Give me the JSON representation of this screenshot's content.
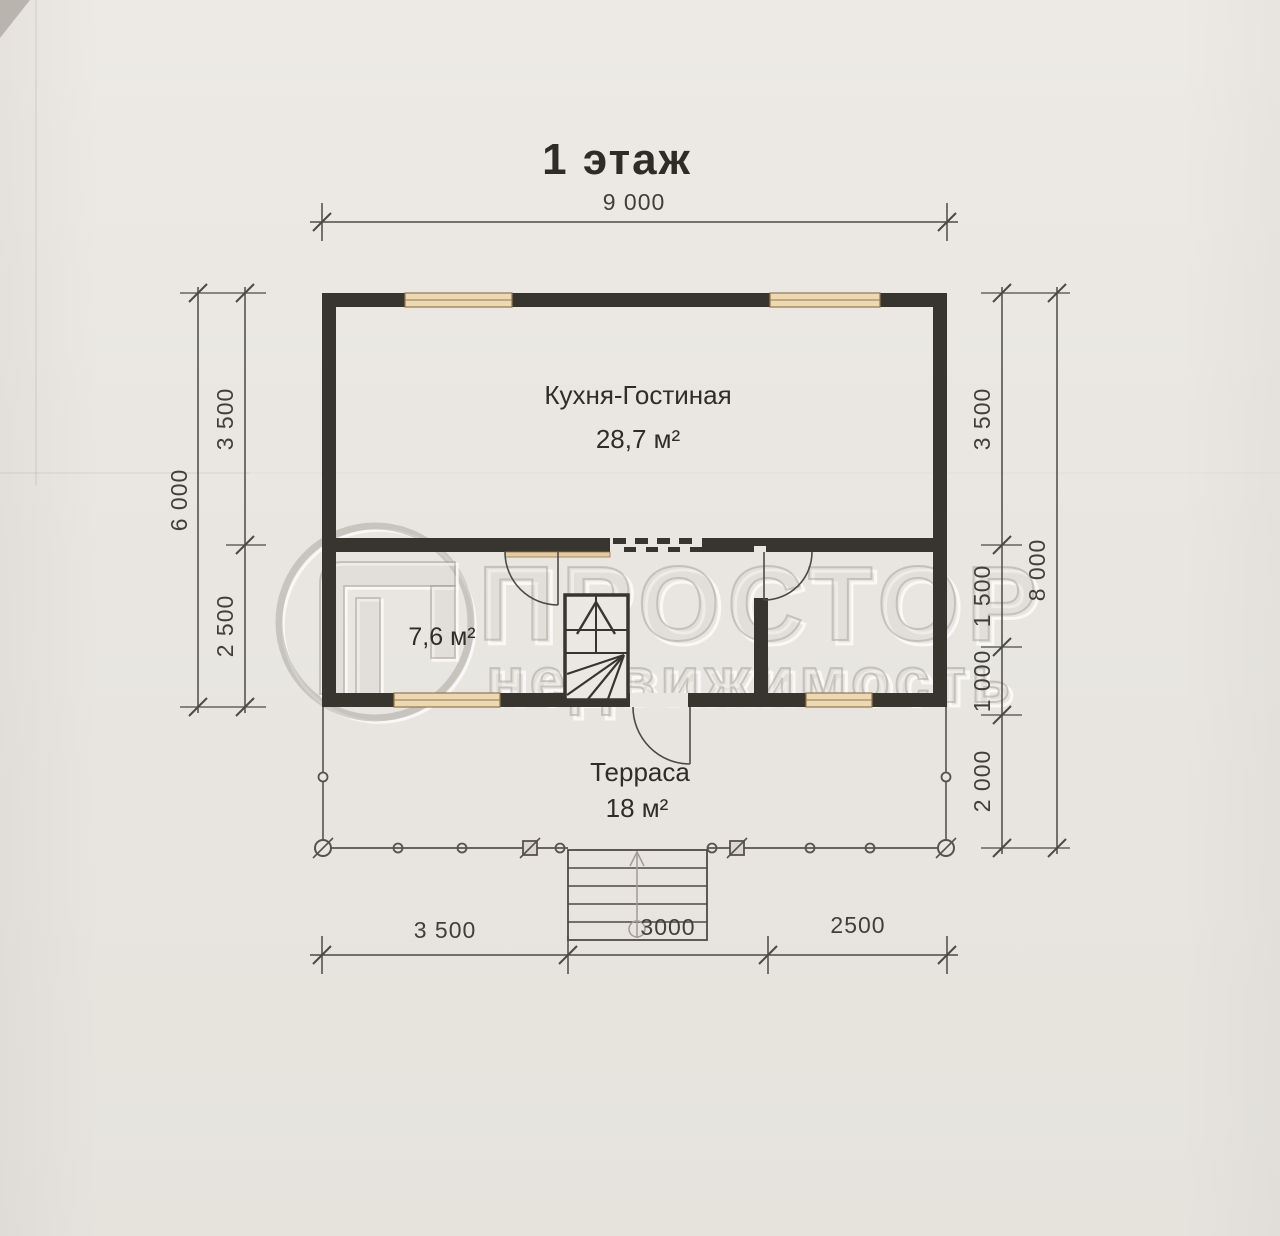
{
  "title": "1 этаж",
  "watermark": {
    "logo": "prostor-logo",
    "line1": "ПРОСТОР",
    "line2": "недвижимость"
  },
  "rooms": {
    "kitchen_living": {
      "name": "Кухня-Гостиная",
      "area": "28,7 м²"
    },
    "hall": {
      "area": "7,6 м²"
    },
    "terrace": {
      "name": "Терраса",
      "area": "18 м²"
    }
  },
  "dimensions": {
    "top": "9 000",
    "left_outer": "6 000",
    "left_segments": [
      "3 500",
      "2 500"
    ],
    "right_segments": [
      "3 500",
      "1 500",
      "1 000",
      "2 000"
    ],
    "right_outer": "8 000",
    "bottom_segments": [
      "3 500",
      "3000",
      "2500"
    ]
  },
  "colors": {
    "paper": "#e9e6e1",
    "wall": "#38352f",
    "window_fill": "#ecd8b2",
    "window_frame": "#96764a",
    "thin_line": "#4c4a45",
    "watermark": "#c9c5be"
  }
}
